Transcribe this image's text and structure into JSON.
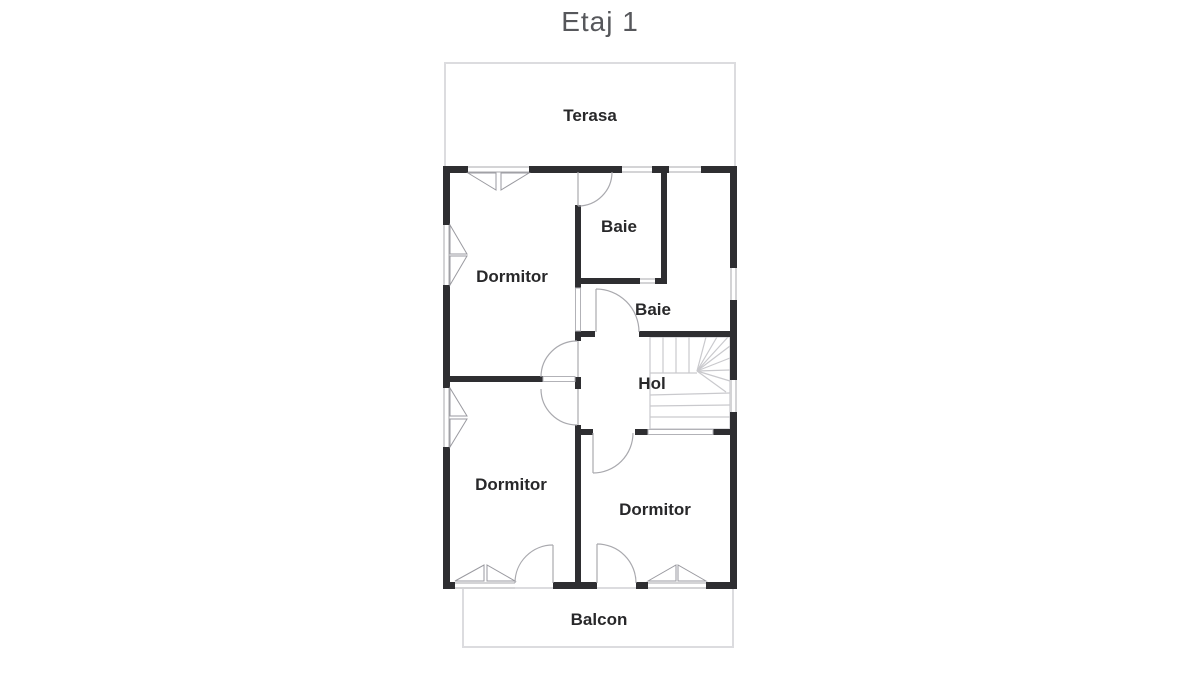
{
  "title": "Etaj 1",
  "floor_plan": {
    "rooms": {
      "terasa": {
        "label": "Terasa"
      },
      "dormitor_top": {
        "label": "Dormitor"
      },
      "baie_top": {
        "label": "Baie"
      },
      "baie_mid": {
        "label": "Baie"
      },
      "hol": {
        "label": "Hol"
      },
      "dormitor_bottom_left": {
        "label": "Dormitor"
      },
      "dormitor_bottom_right": {
        "label": "Dormitor"
      },
      "balcon": {
        "label": "Balcon"
      }
    },
    "colors": {
      "background": "#ffffff",
      "wall": "#2e2e31",
      "thin_wall_line": "#b2b2b7",
      "window_line": "#a8a8ad",
      "door_arc": "#a9a9ae",
      "stair_line": "#c9c9cd",
      "outdoor_outline": "#dcdcdf",
      "title_text": "#56575b",
      "label_text": "#28282a"
    }
  }
}
